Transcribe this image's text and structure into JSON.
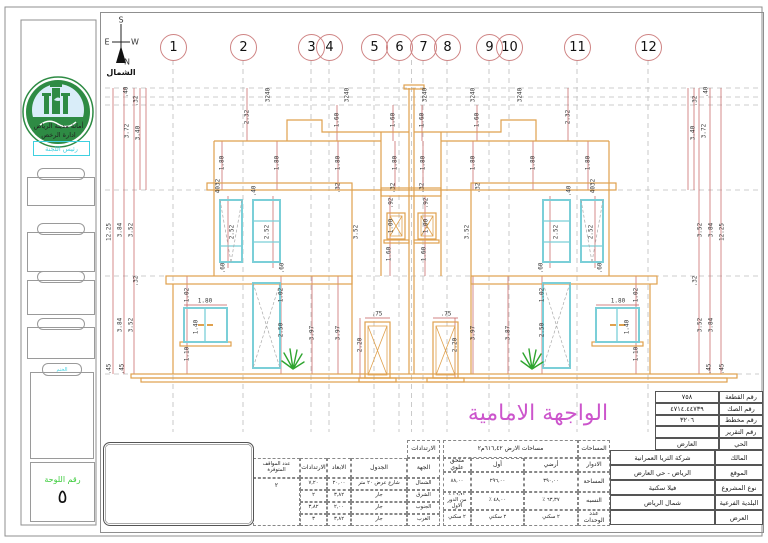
{
  "colors": {
    "orange": "#dfa14e",
    "cyan": "#7bcfd8",
    "red": "#c25b5b",
    "pink": "#cc55cc",
    "green": "#3ecc3e",
    "accent": "#3fd0e0",
    "plant": "#2fa52f",
    "logo_green": "#2e8b44"
  },
  "sidebar": {
    "org_line1": "أمانة مدينة الرياض",
    "org_line2": "ادارة الرخص",
    "chairman": "رئيس اللجنة",
    "logo_alt": "الرياض",
    "stamp_label": "الختم",
    "sheet_label": "رقم اللوحة",
    "sheet_number": "٥"
  },
  "north": {
    "s": "S",
    "e": "E",
    "w": "W",
    "n": "N",
    "label": "الشمال"
  },
  "grid": {
    "columns": [
      {
        "label": "1",
        "x": 173
      },
      {
        "label": "2",
        "x": 243
      },
      {
        "label": "3",
        "x": 311
      },
      {
        "label": "4",
        "x": 329
      },
      {
        "label": "5",
        "x": 374
      },
      {
        "label": "6",
        "x": 399
      },
      {
        "label": "7",
        "x": 423
      },
      {
        "label": "8",
        "x": 447
      },
      {
        "label": "9",
        "x": 489
      },
      {
        "label": "10",
        "x": 509
      },
      {
        "label": "11",
        "x": 577
      },
      {
        "label": "12",
        "x": 648
      }
    ]
  },
  "drawing": {
    "facade_title": "الواجهة الامامية",
    "dim_labels": [
      {
        "t": ".40",
        "x": 126,
        "y": 92,
        "r": 1
      },
      {
        "t": ".32",
        "x": 136,
        "y": 101,
        "r": 1
      },
      {
        "t": "3.72",
        "x": 127,
        "y": 131,
        "r": 1
      },
      {
        "t": "3.40",
        "x": 138,
        "y": 133,
        "r": 1
      },
      {
        "t": "12.25",
        "x": 109,
        "y": 232,
        "r": 1
      },
      {
        "t": "3.84",
        "x": 120,
        "y": 230,
        "r": 1
      },
      {
        "t": "3.52",
        "x": 131,
        "y": 230,
        "r": 1
      },
      {
        "t": ".32",
        "x": 136,
        "y": 281,
        "r": 1
      },
      {
        "t": "3.84",
        "x": 120,
        "y": 325,
        "r": 1
      },
      {
        "t": "3.52",
        "x": 131,
        "y": 325,
        "r": 1
      },
      {
        "t": ".45",
        "x": 109,
        "y": 369,
        "r": 1
      },
      {
        "t": ".45",
        "x": 122,
        "y": 369,
        "r": 1
      },
      {
        "t": ".40",
        "x": 706,
        "y": 92,
        "r": 1
      },
      {
        "t": ".32",
        "x": 695,
        "y": 101,
        "r": 1
      },
      {
        "t": "3.72",
        "x": 704,
        "y": 131,
        "r": 1
      },
      {
        "t": "3.40",
        "x": 693,
        "y": 133,
        "r": 1
      },
      {
        "t": "12.25",
        "x": 722,
        "y": 232,
        "r": 1
      },
      {
        "t": "3.84",
        "x": 711,
        "y": 230,
        "r": 1
      },
      {
        "t": "3.52",
        "x": 700,
        "y": 230,
        "r": 1
      },
      {
        "t": ".32",
        "x": 695,
        "y": 281,
        "r": 1
      },
      {
        "t": "3.84",
        "x": 711,
        "y": 325,
        "r": 1
      },
      {
        "t": "3.52",
        "x": 700,
        "y": 325,
        "r": 1
      },
      {
        "t": ".45",
        "x": 722,
        "y": 369,
        "r": 1
      },
      {
        "t": ".45",
        "x": 709,
        "y": 369,
        "r": 1
      },
      {
        "t": "3240",
        "x": 268,
        "y": 95,
        "r": 1
      },
      {
        "t": "3240",
        "x": 347,
        "y": 95,
        "r": 1
      },
      {
        "t": "3240",
        "x": 425,
        "y": 95,
        "r": 1
      },
      {
        "t": "3240",
        "x": 473,
        "y": 95,
        "r": 1
      },
      {
        "t": "3240",
        "x": 520,
        "y": 95,
        "r": 1
      },
      {
        "t": "2.32",
        "x": 247,
        "y": 117,
        "r": 1
      },
      {
        "t": "2.32",
        "x": 568,
        "y": 117,
        "r": 1
      },
      {
        "t": "1.60",
        "x": 337,
        "y": 120,
        "r": 1
      },
      {
        "t": "1.60",
        "x": 393,
        "y": 120,
        "r": 1
      },
      {
        "t": "1.60",
        "x": 422,
        "y": 120,
        "r": 1
      },
      {
        "t": "1.60",
        "x": 477,
        "y": 120,
        "r": 1
      },
      {
        "t": "1.80",
        "x": 222,
        "y": 163,
        "r": 1
      },
      {
        "t": "1.80",
        "x": 277,
        "y": 163,
        "r": 1
      },
      {
        "t": "1.80",
        "x": 338,
        "y": 163,
        "r": 1
      },
      {
        "t": "1.80",
        "x": 395,
        "y": 163,
        "r": 1
      },
      {
        "t": "1.80",
        "x": 423,
        "y": 163,
        "r": 1
      },
      {
        "t": "1.80",
        "x": 473,
        "y": 163,
        "r": 1
      },
      {
        "t": "1.80",
        "x": 533,
        "y": 163,
        "r": 1
      },
      {
        "t": "1.80",
        "x": 588,
        "y": 163,
        "r": 1
      },
      {
        "t": "4032",
        "x": 218,
        "y": 186,
        "r": 1
      },
      {
        "t": "4032",
        "x": 593,
        "y": 186,
        "r": 1
      },
      {
        "t": ".32",
        "x": 338,
        "y": 188,
        "r": 1
      },
      {
        "t": ".32",
        "x": 393,
        "y": 188,
        "r": 1
      },
      {
        "t": ".32",
        "x": 422,
        "y": 188,
        "r": 1
      },
      {
        "t": ".32",
        "x": 478,
        "y": 188,
        "r": 1
      },
      {
        "t": ".40",
        "x": 254,
        "y": 191,
        "r": 1
      },
      {
        "t": ".40",
        "x": 569,
        "y": 191,
        "r": 1
      },
      {
        "t": ".92",
        "x": 391,
        "y": 203,
        "r": 1
      },
      {
        "t": ".92",
        "x": 426,
        "y": 203,
        "r": 1
      },
      {
        "t": "1.00",
        "x": 391,
        "y": 226,
        "r": 1
      },
      {
        "t": "1.00",
        "x": 426,
        "y": 226,
        "r": 1
      },
      {
        "t": "1.60",
        "x": 389,
        "y": 254,
        "r": 1
      },
      {
        "t": "1.60",
        "x": 424,
        "y": 254,
        "r": 1
      },
      {
        "t": "3.52",
        "x": 356,
        "y": 232,
        "r": 1
      },
      {
        "t": "3.52",
        "x": 467,
        "y": 232,
        "r": 1
      },
      {
        "t": "2.52",
        "x": 232,
        "y": 232,
        "r": 1
      },
      {
        "t": "2.52",
        "x": 267,
        "y": 232,
        "r": 1
      },
      {
        "t": "2.52",
        "x": 556,
        "y": 232,
        "r": 1
      },
      {
        "t": "2.52",
        "x": 591,
        "y": 232,
        "r": 1
      },
      {
        "t": ".60",
        "x": 223,
        "y": 268,
        "r": 1
      },
      {
        "t": ".60",
        "x": 282,
        "y": 268,
        "r": 1
      },
      {
        "t": ".60",
        "x": 541,
        "y": 268,
        "r": 1
      },
      {
        "t": ".60",
        "x": 600,
        "y": 268,
        "r": 1
      },
      {
        "t": "1.02",
        "x": 187,
        "y": 295,
        "r": 1
      },
      {
        "t": "1.02",
        "x": 281,
        "y": 295,
        "r": 1
      },
      {
        "t": "1.02",
        "x": 542,
        "y": 295,
        "r": 1
      },
      {
        "t": "1.02",
        "x": 636,
        "y": 295,
        "r": 1
      },
      {
        "t": "1.40",
        "x": 196,
        "y": 327,
        "r": 1
      },
      {
        "t": "1.40",
        "x": 627,
        "y": 327,
        "r": 1
      },
      {
        "t": "1.10",
        "x": 187,
        "y": 354,
        "r": 1
      },
      {
        "t": "1.10",
        "x": 636,
        "y": 354,
        "r": 1
      },
      {
        "t": "2.50",
        "x": 281,
        "y": 330,
        "r": 1
      },
      {
        "t": "2.50",
        "x": 542,
        "y": 330,
        "r": 1
      },
      {
        "t": "3.97",
        "x": 312,
        "y": 333,
        "r": 1
      },
      {
        "t": "3.97",
        "x": 338,
        "y": 333,
        "r": 1
      },
      {
        "t": "3.97",
        "x": 473,
        "y": 333,
        "r": 1
      },
      {
        "t": "3.87",
        "x": 508,
        "y": 333,
        "r": 1
      },
      {
        "t": "2.20",
        "x": 360,
        "y": 345,
        "r": 1
      },
      {
        "t": "2.20",
        "x": 455,
        "y": 345,
        "r": 1
      },
      {
        "t": "1.80",
        "x": 205,
        "y": 301,
        "r": 0
      },
      {
        "t": "1.80",
        "x": 618,
        "y": 301,
        "r": 0
      },
      {
        "t": ".75",
        "x": 377,
        "y": 314,
        "r": 0
      },
      {
        "t": ".75",
        "x": 446,
        "y": 314,
        "r": 0
      }
    ]
  },
  "info_table": {
    "rows": [
      {
        "label": "رقم القطعة",
        "value": "٧٥٨"
      },
      {
        "label": "رقم الصك",
        "value": "٤٧١٤.٤٤٧٣٩"
      },
      {
        "label": "رقم مخطط",
        "value": "٣٢٠٦"
      },
      {
        "label": "رقم التقرير",
        "value": ""
      },
      {
        "label": "الحي",
        "value": "العارض"
      }
    ]
  },
  "project_table": {
    "rows": [
      {
        "label": "المالك",
        "value": "شركة الثريا العمرانية"
      },
      {
        "label": "الموقع",
        "value": "الرياض - حي العارض"
      },
      {
        "label": "نوع المشروع",
        "value": "فيلا سكنية"
      },
      {
        "label": "البلدية الفرعية",
        "value": "شمال الرياض"
      },
      {
        "label": "العرض",
        "value": ""
      }
    ]
  },
  "areas_table": {
    "corner_label": "المساحات",
    "title": "مساحات الارض ٦١٦,٤٢م٢",
    "floors_label": "الادوار",
    "floors": [
      "أرضي",
      "أول",
      "ملحق علوي"
    ],
    "rows": [
      {
        "label": "المساحة",
        "values": [
          "٣٩٠,٠٠",
          "٢٩٦,٠٠",
          "٨٨,٠٠"
        ]
      },
      {
        "label": "النسبه",
        "values": [
          "٦٣,٣٧ ٪",
          "٤٨,٠٠ ٪",
          "٢٩,٧٣ ٪ من الدور الاول"
        ]
      },
      {
        "label": "عدد الوحدات",
        "values": [
          "٢ سكني",
          "٢ سكني",
          "٢ سكني"
        ]
      }
    ]
  },
  "setbacks_table": {
    "title": "الارتدادات",
    "headers": [
      "الجهة",
      "الجدول",
      "الابعاد",
      "الارتدادات"
    ],
    "parking_header": "عدد المواقف المتوفرة",
    "parking_value": "٢",
    "rows": [
      [
        "الشمال",
        "شارع عرض ٢٠ متر",
        "٢٠,٠٠",
        "٧,٢٠"
      ],
      [
        "الشرق",
        "جار",
        "٣,٨٢",
        "٢"
      ],
      [
        "الجنوب",
        "جار",
        "٢,٠٠",
        "٣,٨٢"
      ],
      [
        "الغرب",
        "جار",
        "٣,٨٢",
        "٣"
      ]
    ]
  }
}
